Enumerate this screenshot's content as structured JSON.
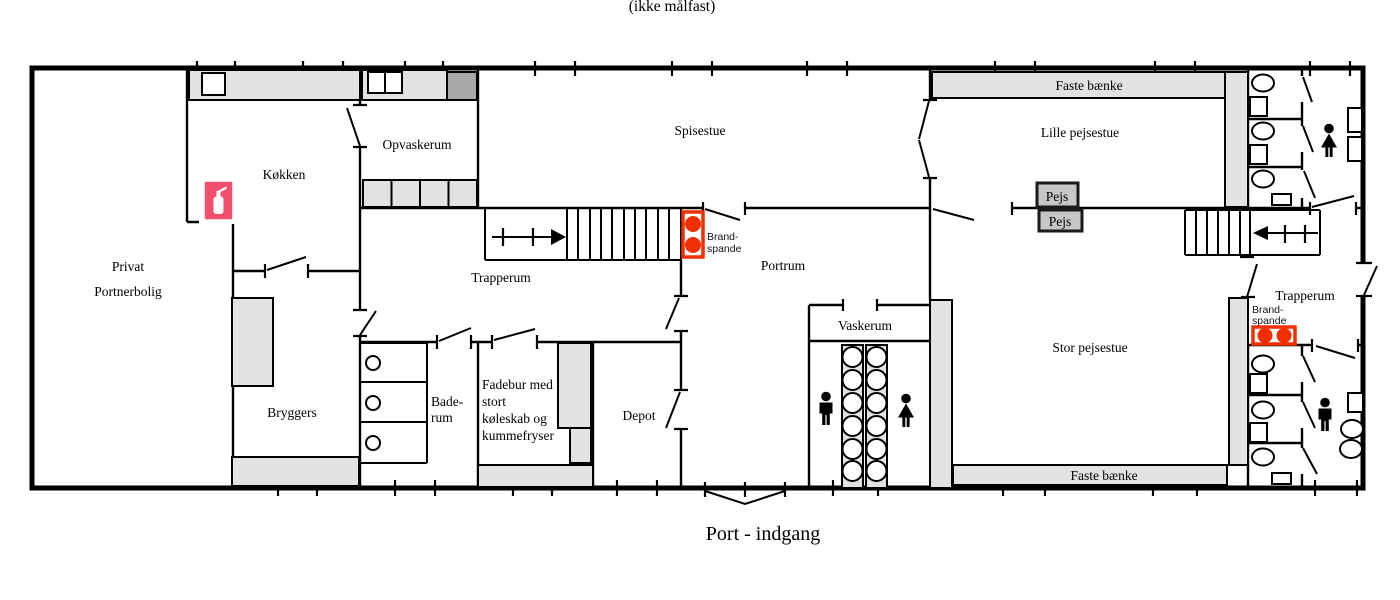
{
  "title": "(ikke målfast)",
  "entrance": "Port - indgang",
  "rooms": {
    "private1": "Privat",
    "private2": "Portnerbolig",
    "kitchen": "Køkken",
    "dishroom": "Opvaskerum",
    "dining": "Spisestue",
    "small_lounge": "Lille pejsestue",
    "big_lounge": "Stor pejsestue",
    "stair_left": "Trapperum",
    "stair_right": "Trapperum",
    "portroom": "Portrum",
    "washroom": "Vaskerum",
    "scullery": "Bryggers",
    "bath1": "Bade-",
    "bath2": "rum",
    "pantry1": "Fadebur med",
    "pantry2": "stort",
    "pantry3": "køleskab og",
    "pantry4": "kummefryser",
    "depot": "Depot"
  },
  "fixtures": {
    "benches_top": "Faste bænke",
    "benches_bottom": "Faste bænke",
    "fireplace": "Pejs",
    "firebuckets1": "Brand-",
    "firebuckets2": "spande"
  },
  "colors": {
    "extinguisher_sign": "#f0506e",
    "fire_red": "#f03000",
    "counter_gray": "#e2e2e2",
    "dark_gray": "#a8a8a8",
    "wall": "#000000"
  }
}
